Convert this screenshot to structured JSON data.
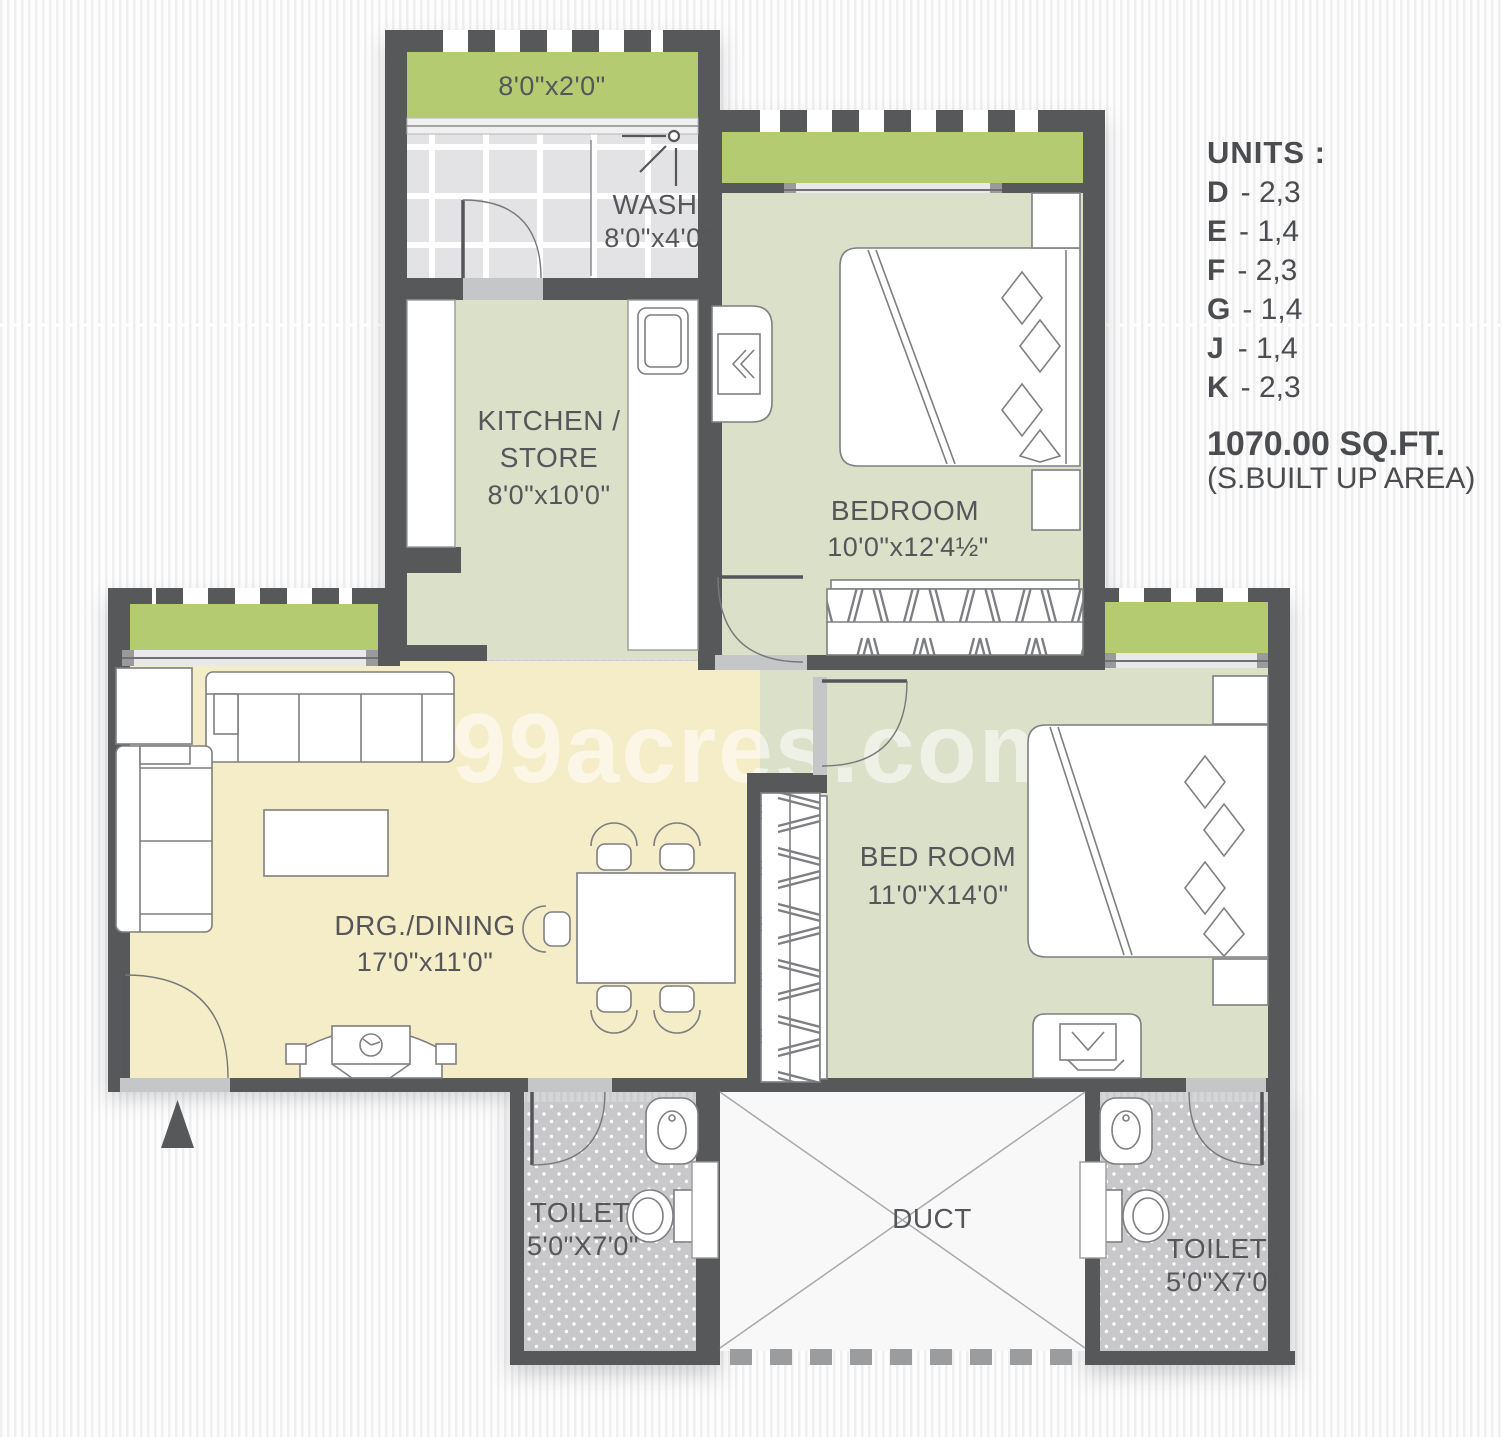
{
  "watermark": "99acres.com",
  "units_panel": {
    "heading": "UNITS :",
    "items": [
      {
        "letter": "D",
        "rest": "- 2,3"
      },
      {
        "letter": "E",
        "rest": "- 1,4"
      },
      {
        "letter": "F",
        "rest": "- 2,3"
      },
      {
        "letter": "G",
        "rest": "- 1,4"
      },
      {
        "letter": "J",
        "rest": "- 1,4"
      },
      {
        "letter": "K",
        "rest": "- 2,3"
      }
    ],
    "area": "1070.00 SQ.FT.",
    "area_note": "(S.BUILT UP AREA)"
  },
  "rooms": {
    "balcony_top": {
      "dim": "8'0\"x2'0\""
    },
    "wash": {
      "name": "WASH",
      "dim": "8'0\"x4'0\""
    },
    "kitchen": {
      "name_line1": "KITCHEN /",
      "name_line2": "STORE",
      "dim": "8'0\"x10'0\""
    },
    "bedroom_top": {
      "name": "BEDROOM",
      "dim": "10'0\"x12'4½\""
    },
    "drg_dining": {
      "name": "DRG./DINING",
      "dim": "17'0\"x11'0\""
    },
    "bedroom_bottom": {
      "name": "BED ROOM",
      "dim": "11'0\"X14'0\""
    },
    "toilet_left": {
      "name": "TOILET",
      "dim": "5'0\"X7'0\""
    },
    "toilet_right": {
      "name": "TOILET",
      "dim": "5'0\"X7'0\""
    },
    "duct": {
      "name": "DUCT"
    }
  },
  "colors": {
    "wall": "#57585a",
    "balcony_green": "#b4cb72",
    "room_sage": "#dbe0c9",
    "living_cream": "#f5ecc8",
    "tile_gray": "#e3e3e5",
    "toilet_floor": "#c8c8ca",
    "threshold": "#c5c6c8",
    "label_text": "#55565a"
  }
}
